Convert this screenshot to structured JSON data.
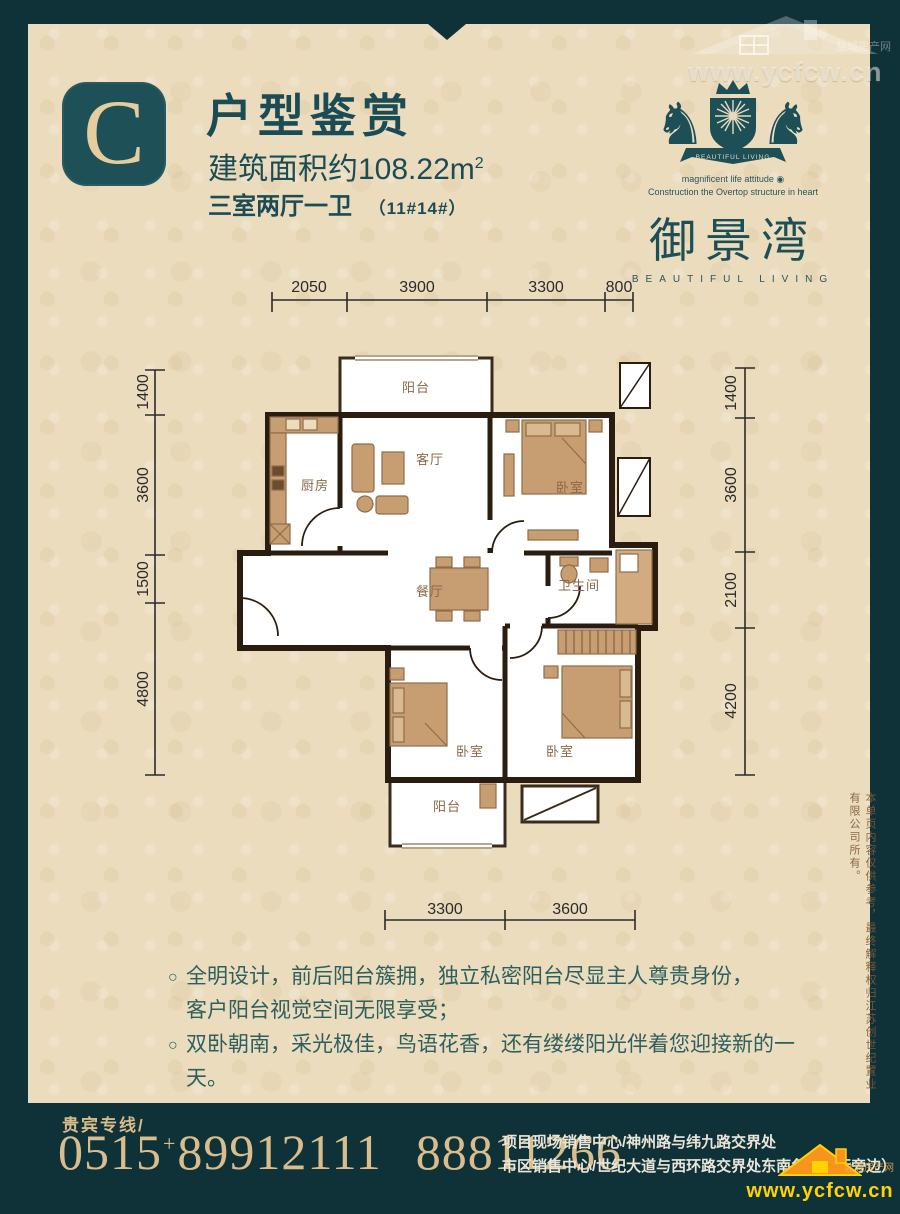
{
  "watermark_top": {
    "url": "www.ycfcw.cn",
    "site": "盐城房产网"
  },
  "header": {
    "letter": "C",
    "title": "户型鉴赏",
    "area_prefix": "建筑面积约108.22m",
    "area_sup": "2",
    "layout": "三室两厅一卫",
    "units": "（11#14#）"
  },
  "brand": {
    "banner": "BEAUTIFUL LIVING",
    "slogan1": "magnificent life attitude ◉",
    "slogan2": "Construction the Overtop structure in heart",
    "name": "御景湾",
    "name_en": "BEAUTIFUL LIVING"
  },
  "plan": {
    "dims": {
      "top": [
        "2050",
        "3900",
        "3300",
        "800"
      ],
      "left": [
        "1400",
        "3600",
        "1500",
        "4800"
      ],
      "right": [
        "1400",
        "3600",
        "2100",
        "4200"
      ],
      "bottom": [
        "3300",
        "3600"
      ]
    },
    "rooms": {
      "balcony_top": "阳台",
      "kitchen": "厨房",
      "living": "客厅",
      "bedroom_tr": "卧室",
      "dining": "餐厅",
      "bath": "卫生间",
      "bedroom_bl": "卧室",
      "bedroom_br": "卧室",
      "balcony_bottom": "阳台"
    }
  },
  "features": {
    "marker": "○",
    "items": [
      {
        "lines": [
          "全明设计，前后阳台簇拥，独立私密阳台尽显主人尊贵身份，",
          "客户阳台视觉空间无限享受；"
        ]
      },
      {
        "lines": [
          "双卧朝南，采光极佳，鸟语花香，还有缕缕阳光伴着您迎接新的一天。"
        ]
      }
    ]
  },
  "disclaimer": {
    "text": "本单页内容仅供参考，最终解释权归江苏创世纪置业有限公司所有。"
  },
  "footer": {
    "vip_label": "贵宾专线/",
    "phone_area": "0515",
    "phone_plus": "+",
    "phone1": "89912111",
    "phone2": "88811266",
    "address1": "项目现场销售中心/神州路与纬九路交界处",
    "address2": "市区销售中心/世纪大道与西环路交界处东南角（中行旁边）",
    "site_url": "www.ycfcw.cn",
    "site_name": "盐城房产网"
  }
}
